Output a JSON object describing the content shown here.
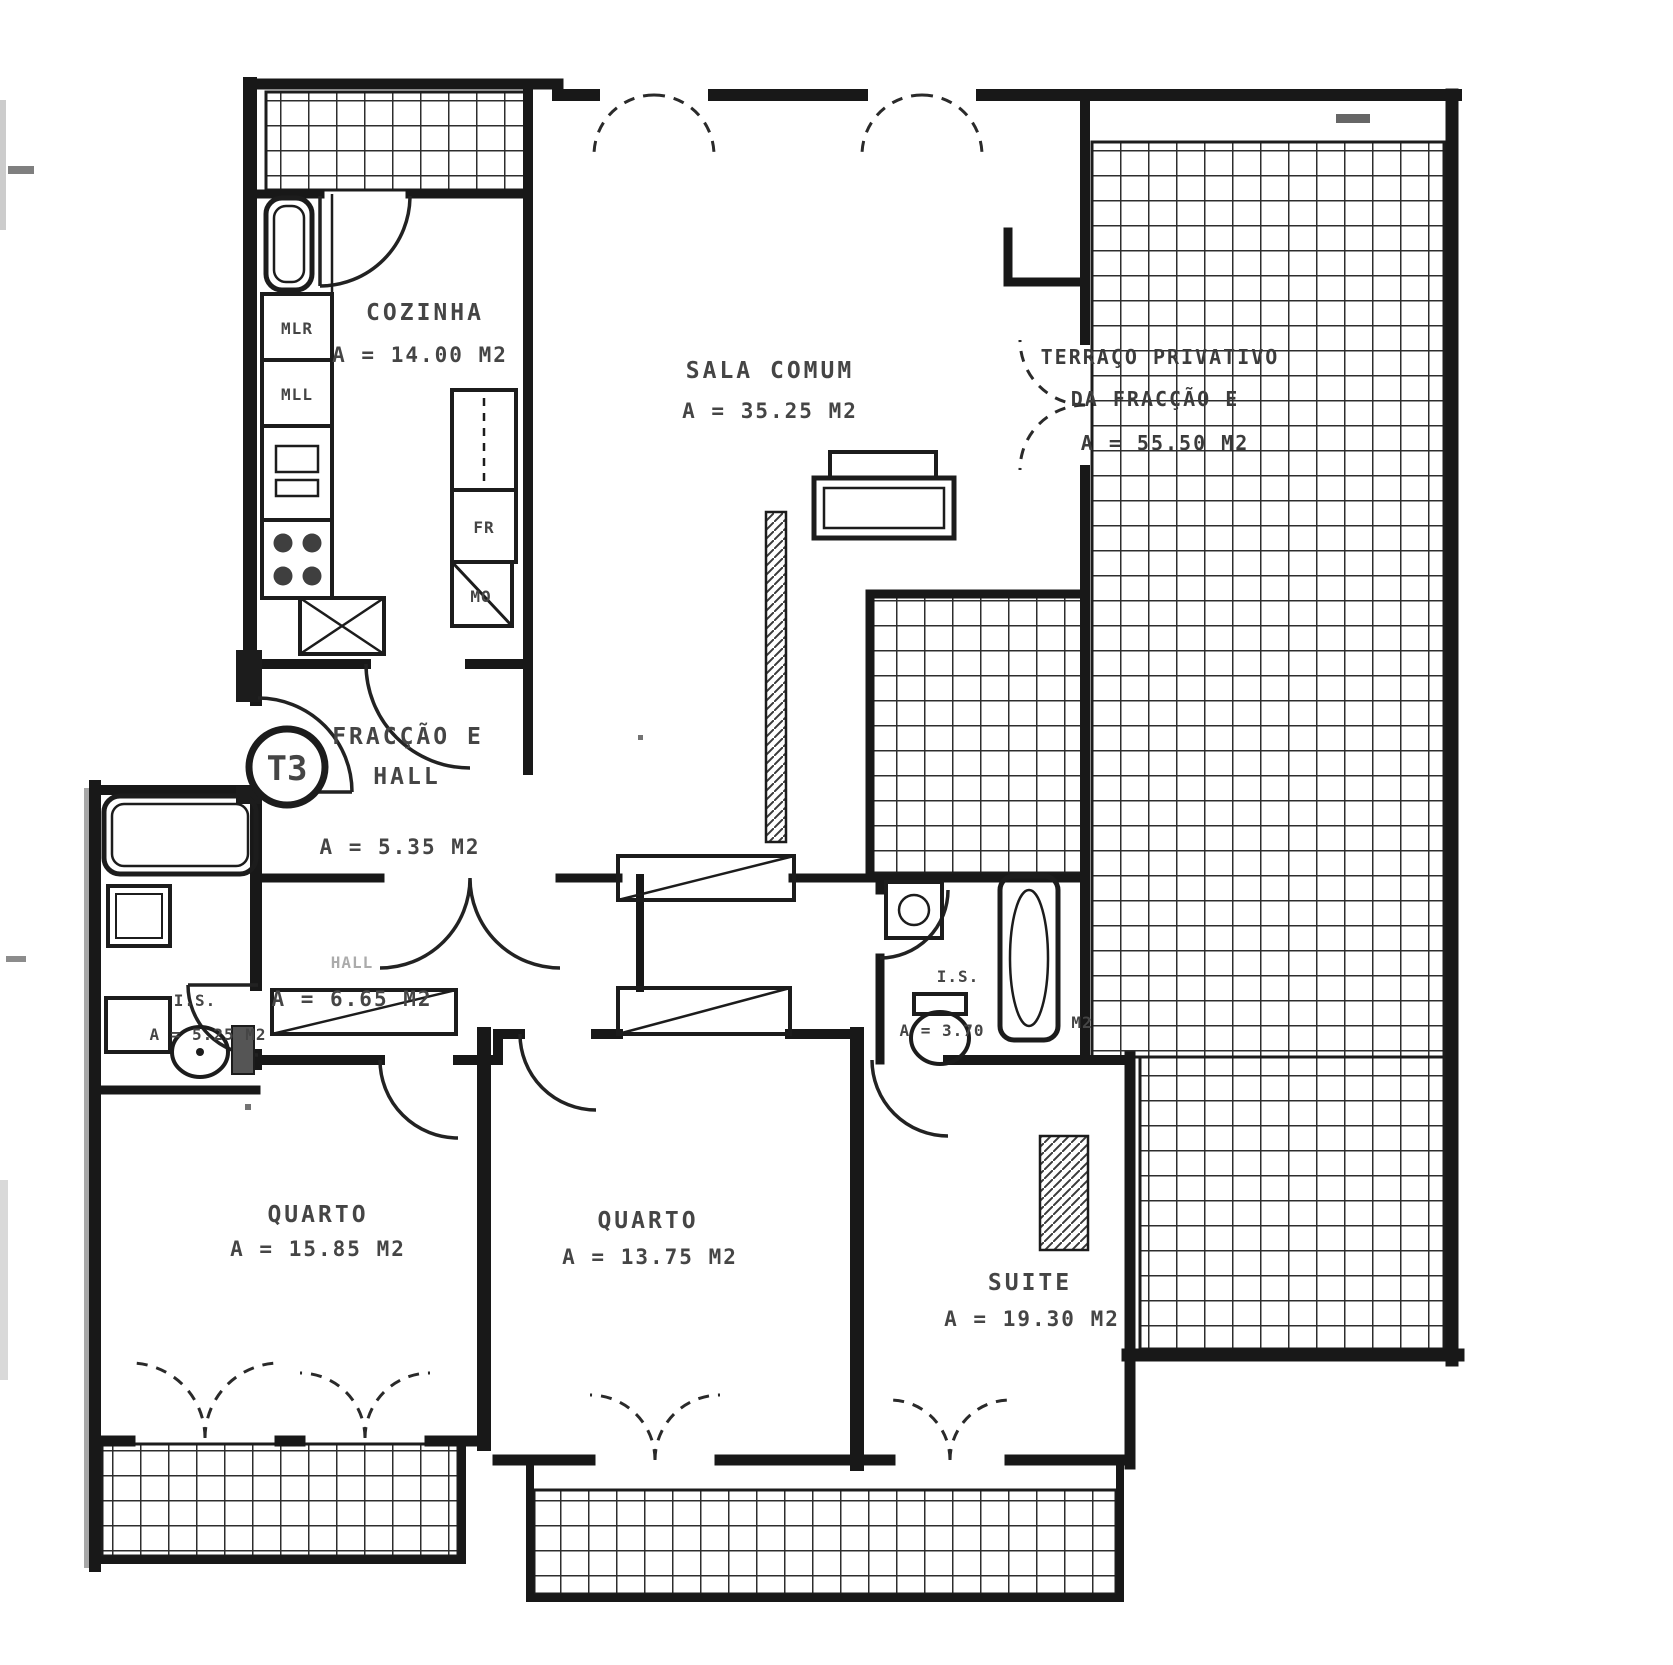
{
  "plan": {
    "badge": "T3",
    "colors": {
      "ink": "#1c1c1c",
      "text": "#454545",
      "paper": "#ffffff"
    }
  },
  "rooms": {
    "cozinha": {
      "name": "COZINHA",
      "area": "A = 14.00 M2"
    },
    "sala_comum": {
      "name": "SALA COMUM",
      "area": "A = 35.25 M2"
    },
    "terraco": {
      "line1": "TERRAÇO PRIVATIVO",
      "line2": "DA FRACÇÃO E",
      "area": "A = 55.50 M2"
    },
    "hall_entrada": {
      "line1": "FRACÇÃO E",
      "line2": "HALL",
      "area": "A = 5.35 M2"
    },
    "hall": {
      "name": "HALL",
      "area": "A = 6.65 M2"
    },
    "is_left": {
      "name": "I.S.",
      "area": "A = 5.25 M2"
    },
    "is_right": {
      "name": "I.S.",
      "area": "A = 3.70",
      "unit": "M2"
    },
    "quarto_left": {
      "name": "QUARTO",
      "area": "A = 15.85 M2"
    },
    "quarto_middle": {
      "name": "QUARTO",
      "area": "A = 13.75 M2"
    },
    "suite": {
      "name": "SUITE",
      "area": "A = 19.30 M2"
    }
  },
  "appliances": {
    "mlr": "MLR",
    "mll": "MLL",
    "fr": "FR",
    "mo": "MO"
  }
}
